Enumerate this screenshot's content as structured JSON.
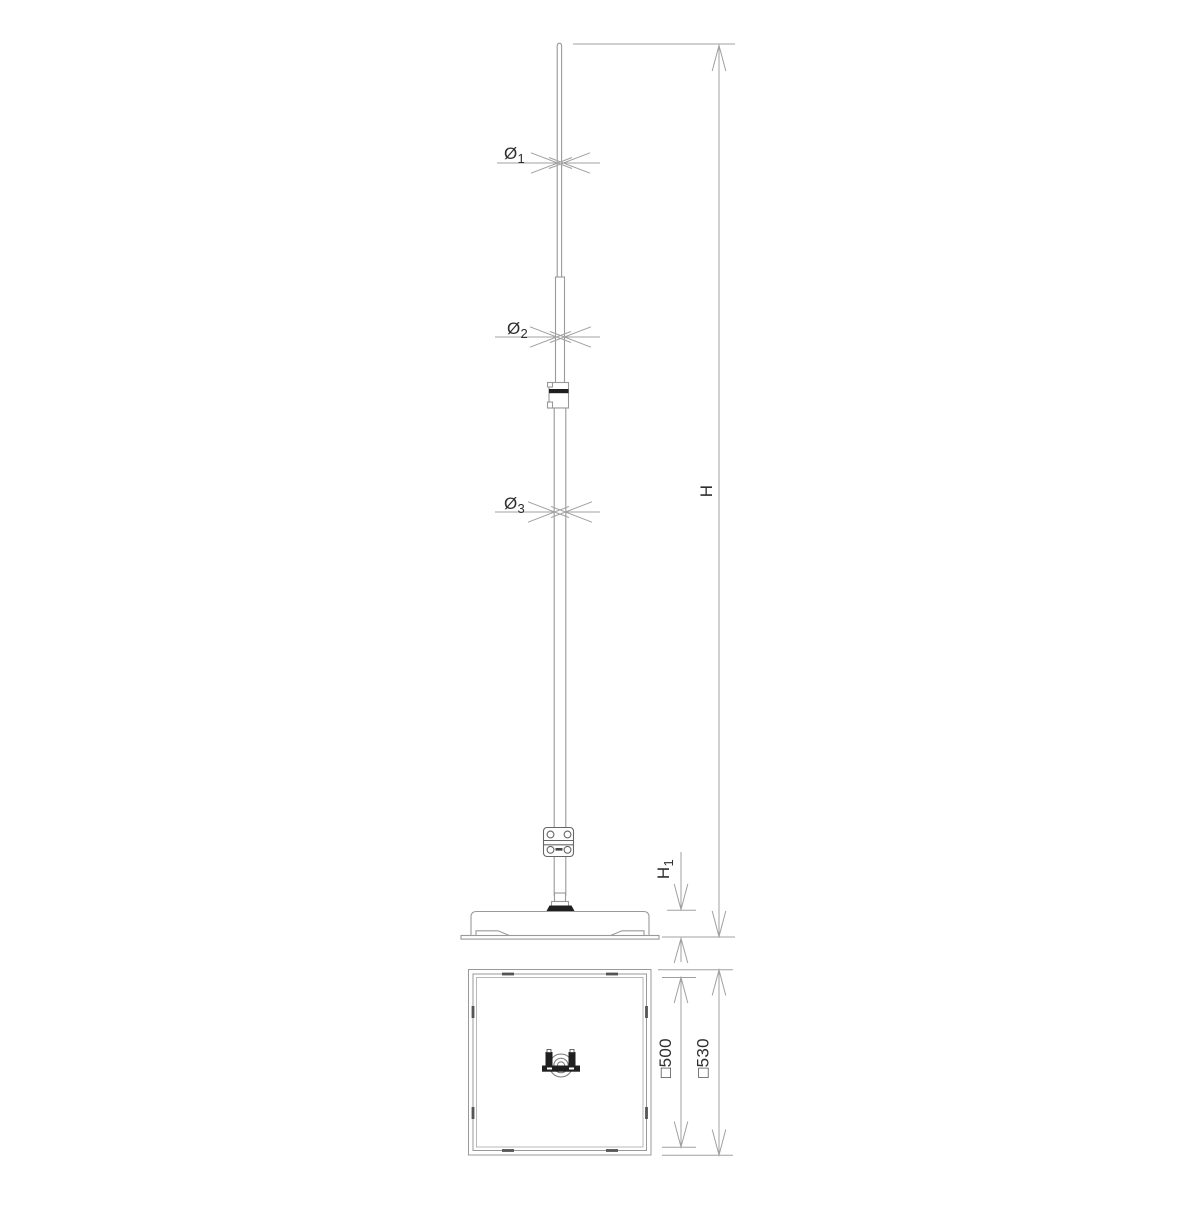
{
  "drawing": {
    "labels": {
      "dia1": {
        "base": "Ø",
        "sub": "1"
      },
      "dia2": {
        "base": "Ø",
        "sub": "2"
      },
      "dia3": {
        "base": "Ø",
        "sub": "3"
      },
      "height": {
        "base": "H",
        "sub": ""
      },
      "height1": {
        "base": "H",
        "sub": "1"
      },
      "base_inner": "□500",
      "base_outer": "□530"
    },
    "colors": {
      "background": "#ffffff",
      "dimension_line": "#a0a0a0",
      "object_line": "#999999",
      "detail_line": "#666666",
      "dark_fill": "#1f1f1f",
      "text": "#2e2e2e"
    }
  }
}
